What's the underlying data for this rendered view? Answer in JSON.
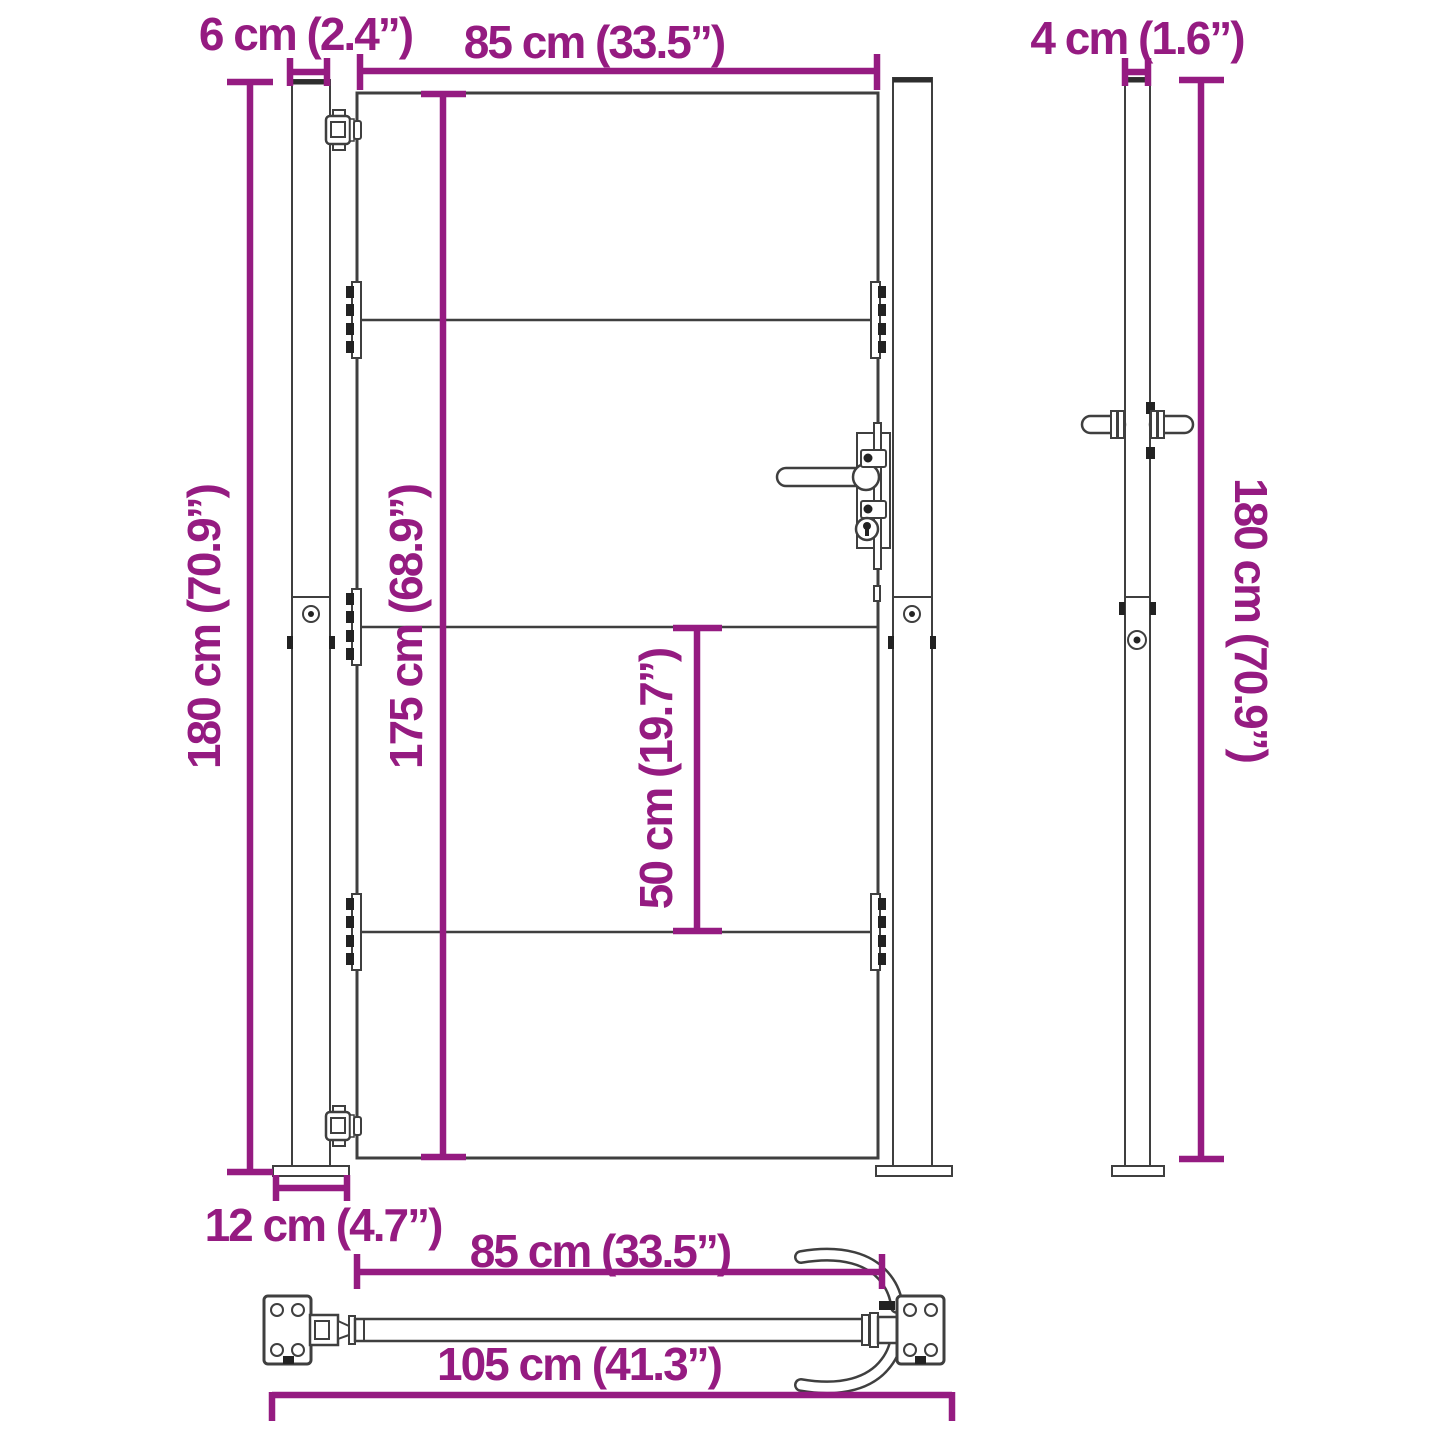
{
  "colors": {
    "accent": "#951B81",
    "line_art": "#3F3F3F"
  },
  "views": {
    "front": {
      "post_width": "6 cm (2.4”)",
      "gate_width": "85 cm (33.5”)",
      "post_height_left": "180 cm (70.9”)",
      "gate_height": "175 cm (68.9”)",
      "panel_spacing": "50 cm (19.7”)",
      "base_plate_width": "12 cm (4.7”)"
    },
    "side": {
      "post_depth": "4 cm (1.6”)",
      "post_height": "180 cm (70.9”)"
    },
    "top": {
      "gate_width": "85 cm (33.5”)",
      "total_width": "105 cm (41.3”)"
    }
  }
}
